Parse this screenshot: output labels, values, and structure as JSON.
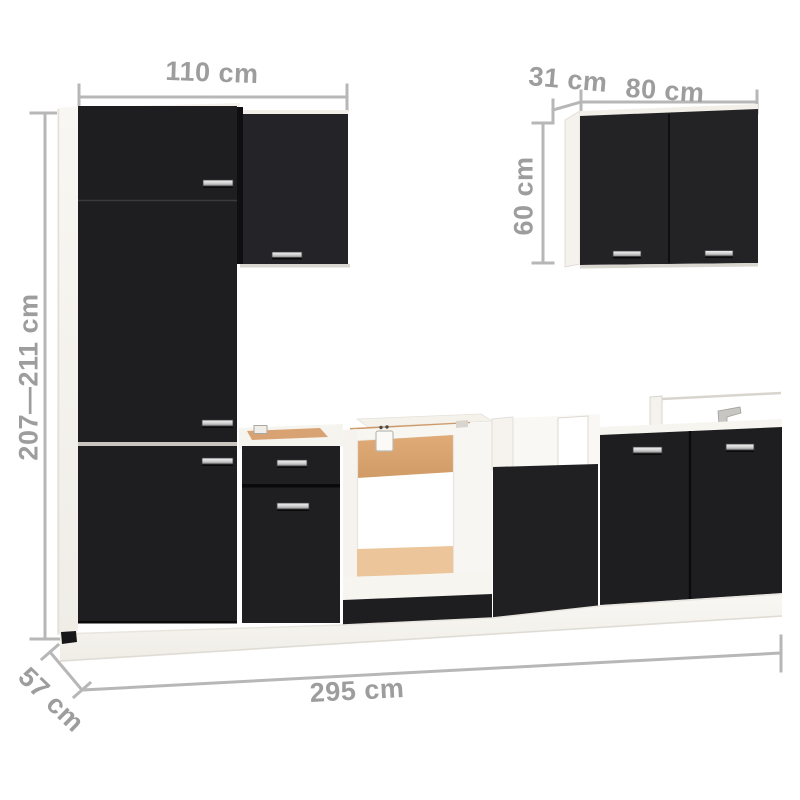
{
  "scene": {
    "description": "Dimension diagram of a black kitchen cabinet furniture set on white background",
    "background": "#ffffff"
  },
  "palette": {
    "front_black": "#1e1e20",
    "carcass_white": "#f7f5f1",
    "plywood": "#dca873",
    "plywood_light": "#ecc59b",
    "handle_silver": "#cfcfcf",
    "dimension_line": "#b7b7b7",
    "dimension_text": "#9d9d9d"
  },
  "dimensions": {
    "tall_width": {
      "label": "110 cm"
    },
    "wall_depth": {
      "label": "31 cm"
    },
    "wall_width": {
      "label": "80 cm"
    },
    "wall_height": {
      "label": "60 cm"
    },
    "tall_height": {
      "label": "207—211 cm"
    },
    "base_depth": {
      "label": "57 cm"
    },
    "total_width": {
      "label": "295 cm"
    }
  }
}
